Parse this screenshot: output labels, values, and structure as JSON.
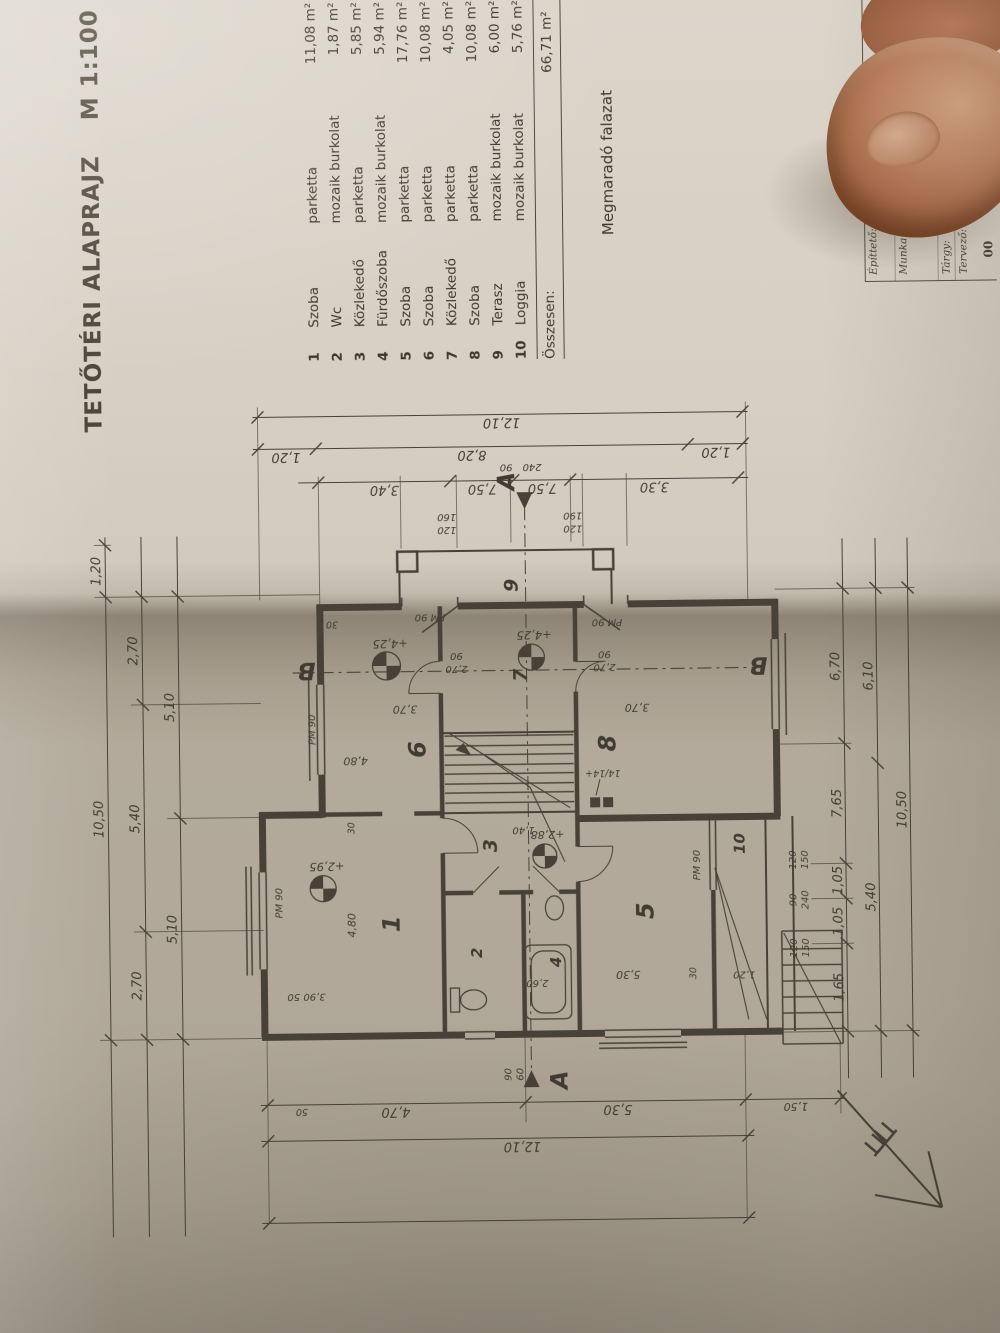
{
  "title": {
    "main": "TETŐTÉRI ALAPRAJZ",
    "scale": "M 1:100"
  },
  "legend": "Megmaradó falazat",
  "schedule": {
    "rows": [
      {
        "no": "1",
        "name": "Szoba",
        "finish": "parketta",
        "area": "11,08 m²"
      },
      {
        "no": "2",
        "name": "Wc",
        "finish": "mozaik burkolat",
        "area": "1,87 m²"
      },
      {
        "no": "3",
        "name": "Közlekedő",
        "finish": "parketta",
        "area": "5,85 m²"
      },
      {
        "no": "4",
        "name": "Fürdőszoba",
        "finish": "mozaik burkolat",
        "area": "5,94 m²"
      },
      {
        "no": "5",
        "name": "Szoba",
        "finish": "parketta",
        "area": "17,76 m²"
      },
      {
        "no": "6",
        "name": "Szoba",
        "finish": "parketta",
        "area": "10,08 m²"
      },
      {
        "no": "7",
        "name": "Közlekedő",
        "finish": "parketta",
        "area": "4,05 m²"
      },
      {
        "no": "8",
        "name": "Szoba",
        "finish": "parketta",
        "area": "10,08 m²"
      },
      {
        "no": "9",
        "name": "Terasz",
        "finish": "mozaik burkolat",
        "area": "6,00 m²"
      },
      {
        "no": "10",
        "name": "Loggia",
        "finish": "mozaik burkolat",
        "area": "5,76 m²"
      }
    ],
    "total_label": "Összesen:",
    "total": "66,71 m²"
  },
  "title_block": {
    "owner_label": "Építtető:",
    "owner": "Czeglédy Ferenc",
    "owner_address": "Abasár, Vörösmarty út 2/1",
    "work_label": "Munka:",
    "work": "Családi ház átalakítás engedélyez…",
    "work_address": "Abasár, Vörösm…",
    "parcel_label": "Hrsz.:",
    "work_note": "Felmér…",
    "subject_label": "Tárgy:",
    "designer_label": "Tervező:",
    "sheet_no": "00"
  },
  "plan": {
    "rooms": [
      "1",
      "2",
      "3",
      "4",
      "5",
      "6",
      "7",
      "8",
      "9",
      "10"
    ],
    "chains_top": {
      "overall": "10,50",
      "offset": "1,20",
      "mid": [
        "2,70",
        "5,40",
        "2,70"
      ],
      "inner": [
        "5,10",
        "5,10"
      ]
    },
    "chains_bottom": {
      "inner": [
        "1,65",
        "1,05",
        "1,05",
        "7,65",
        "6,70"
      ],
      "mid": [
        "5,40",
        "6,10"
      ],
      "overall": "10,50"
    },
    "chains_right": {
      "inner": [
        "3,40",
        "7,50",
        "7,50",
        "3,30"
      ],
      "mid": [
        "1,20",
        "8,20",
        "1,20"
      ],
      "overall": "12,10"
    },
    "chains_left": {
      "inner": [
        "4,70",
        "5,30",
        "1,50"
      ],
      "overall": "12,10",
      "wall": "50"
    },
    "levels": {
      "room1": "+2,95",
      "stair": "+2,88",
      "room6": "+4,25",
      "room7": "+4,25"
    },
    "pm_label": "PM 90",
    "specs": {
      "terrace_upper": [
        "120",
        "160"
      ],
      "terrace_lower": [
        "120",
        "190"
      ],
      "loggia_a": [
        "120",
        "150"
      ],
      "loggia_b": [
        "90",
        "240"
      ],
      "loggia_c": [
        "120",
        "150"
      ],
      "section_a_left": [
        "90",
        "60"
      ],
      "section_a_right": [
        "90",
        "240"
      ],
      "door7a": [
        "2,70",
        "90"
      ],
      "door7b": [
        "2,70",
        "90"
      ]
    },
    "inner_dims": {
      "room1_w": "4,80",
      "room1_d": "3,90  50",
      "room6_w": "4,80",
      "room6_d": "3,70",
      "room8_d": "3,70",
      "room5_d": "5,30",
      "stair_w": "1,40",
      "bath": "2,60",
      "wall_a": "30",
      "wall_b": "30",
      "wall_c": "30",
      "loggia_w": "1,20",
      "chimney": "14/14+"
    },
    "sections": {
      "a": "A",
      "b": "B"
    }
  }
}
